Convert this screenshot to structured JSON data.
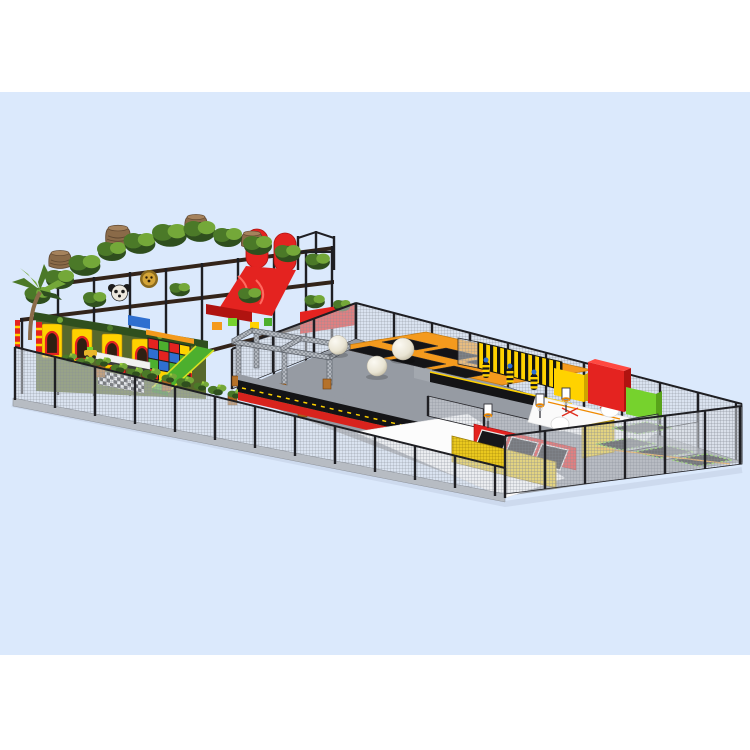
{
  "meta": {
    "type": "3d-product-render",
    "subject": "Jungle themed indoor playground combined with trampoline park",
    "view": "isometric render on light blue studio backdrop",
    "canvas": {
      "width": 750,
      "height": 750
    }
  },
  "palette": {
    "page_bg": "#ffffff",
    "sky_band": "#dbe9fc",
    "shadow": "#c6d2e6",
    "frame_dark": "#33241a",
    "foliage_dark": "#2f4f1e",
    "foliage_mid": "#4b7928",
    "foliage_light": "#74a839",
    "plant_accent": "#9acc3a",
    "trunk_brown": "#8a6a48",
    "trunk_dark": "#5f4730",
    "red_primary": "#e42320",
    "red_dark": "#b01310",
    "yellow_primary": "#ffd200",
    "yellow_deep": "#e8b62a",
    "orange_frame": "#f49a1d",
    "green_slide": "#4caf2e",
    "green_bright": "#76d22d",
    "blue_accent": "#2f6fd0",
    "gray_floor": "#969ba3",
    "gray_light": "#b7bcc3",
    "gray_truss": "#b4b9c0",
    "mesh_line": "#878d96",
    "yellow_mesh": "#eac81e",
    "black_bed": "#141416",
    "ball_white": "#f4f1e6",
    "white_pure": "#ffffff",
    "facade_olive": "#57682c"
  },
  "scene": {
    "backdrop": {
      "band_top": 92,
      "band_bottom": 655,
      "label": "light blue band on white"
    },
    "zones": [
      {
        "id": "jungle-soft-play",
        "label": "Jungle themed soft play structure",
        "features": [
          "tree canopy",
          "tree trunk houses",
          "panda head",
          "lion head",
          "red wave slide",
          "palm tree",
          "arched castle facade",
          "rainbow climbing block wall",
          "snack counter with red stools",
          "checkered floor",
          "green slide",
          "ride-on car"
        ]
      },
      {
        "id": "trampoline-court",
        "label": "Trampoline court with spider tower and giant balls",
        "features": [
          "zone divider mesh fence",
          "back perimeter mesh fence",
          "spider tower truss structure",
          "three giant white balls",
          "orange framed trampoline grid",
          "jungle planter boxes",
          "tumbling lanes with red and yellow edging"
        ]
      },
      {
        "id": "ninja-jump-zone",
        "label": "Ninja course and jump performance zone",
        "features": [
          "yellow black striped wall",
          "hanging ninja bags",
          "tumbling track",
          "foam climbing pads yellow red green",
          "white airbag beds with cross marks",
          "slam dunk lanes with basketball hoops",
          "yellow mesh barriers",
          "green edged trampolines",
          "end perimeter mesh fence",
          "white walkway"
        ]
      }
    ]
  }
}
